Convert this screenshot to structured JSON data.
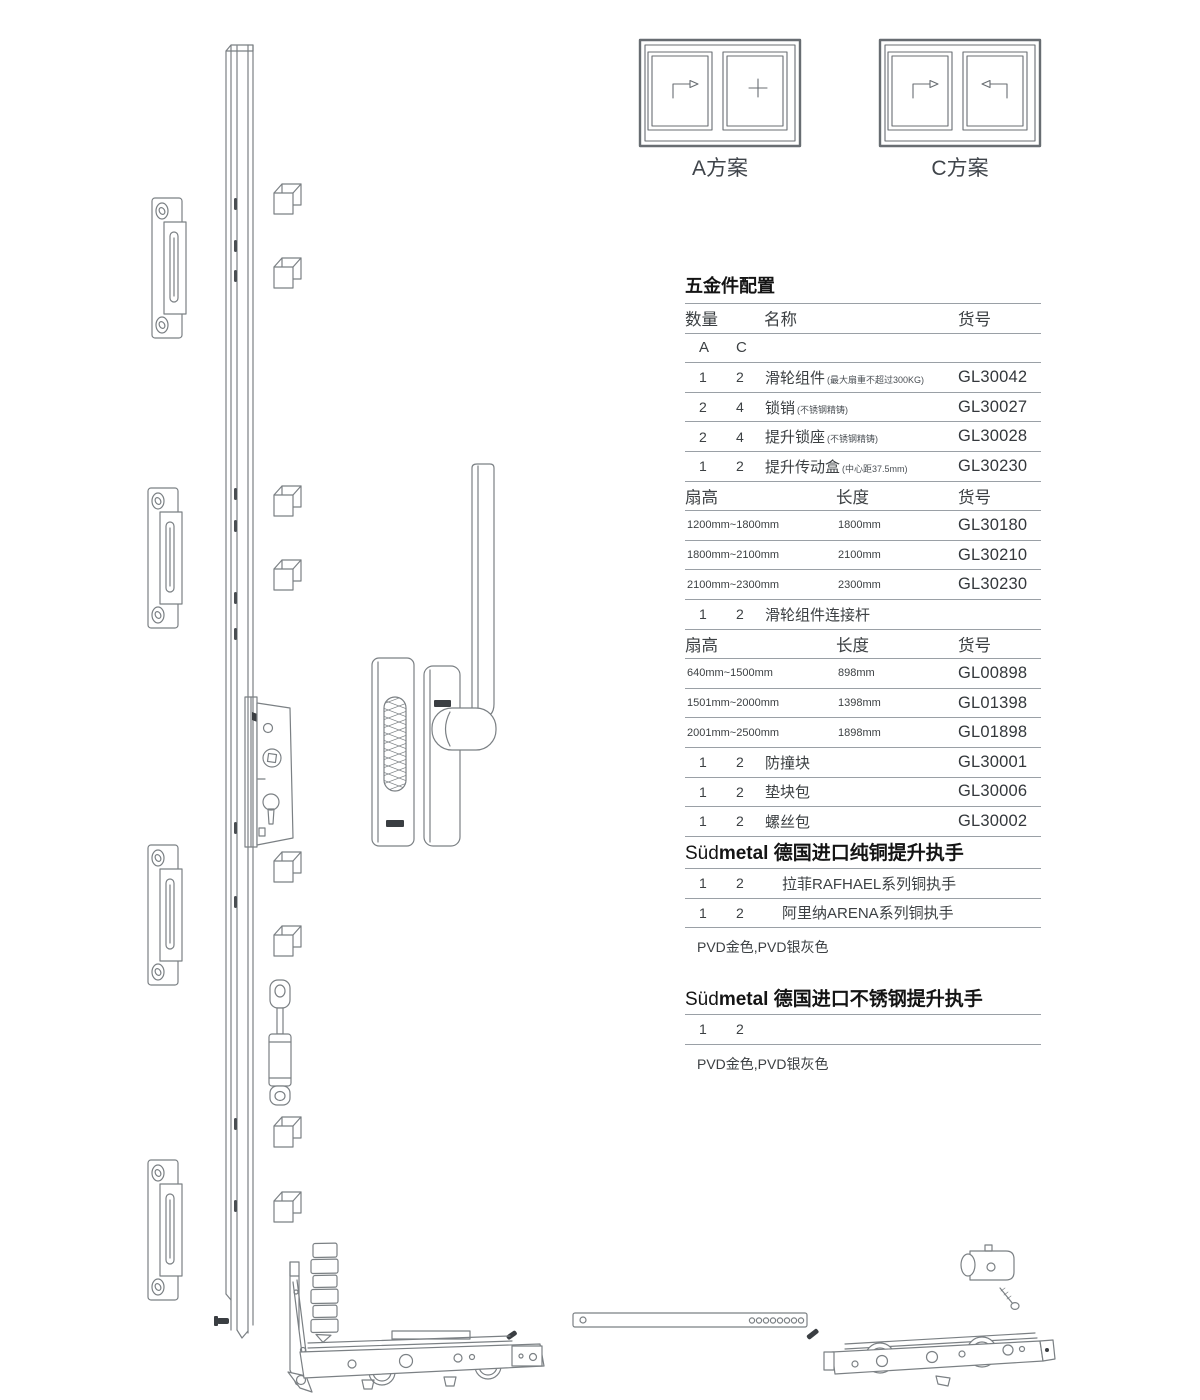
{
  "window_plans": {
    "a_label": "A方案",
    "c_label": "C方案"
  },
  "hardware_table": {
    "title": "五金件配置",
    "header": {
      "qty": "数量",
      "name": "名称",
      "sku": "货号"
    },
    "qty_columns": {
      "a": "A",
      "c": "C"
    },
    "parts": [
      {
        "a": "1",
        "c": "2",
        "name": "滑轮组件",
        "note": "(最大扇重不超过300KG)",
        "sku": "GL30042"
      },
      {
        "a": "2",
        "c": "4",
        "name": "锁销",
        "note": "(不锈钢精铸)",
        "sku": "GL30027"
      },
      {
        "a": "2",
        "c": "4",
        "name": "提升锁座",
        "note": "(不锈钢精铸)",
        "sku": "GL30028"
      },
      {
        "a": "1",
        "c": "2",
        "name": "提升传动盒",
        "note": "(中心距37.5mm)",
        "sku": "GL30230"
      }
    ],
    "length_table_1": {
      "header": {
        "col1": "扇高",
        "col2": "长度",
        "col3": "货号"
      },
      "rows": [
        {
          "range": "1200mm~1800mm",
          "length": "1800mm",
          "sku": "GL30180"
        },
        {
          "range": "1800mm~2100mm",
          "length": "2100mm",
          "sku": "GL30210"
        },
        {
          "range": "2100mm~2300mm",
          "length": "2300mm",
          "sku": "GL30230"
        }
      ]
    },
    "connector_row": {
      "a": "1",
      "c": "2",
      "name": "滑轮组件连接杆",
      "note": "",
      "sku": ""
    },
    "length_table_2": {
      "header": {
        "col1": "扇高",
        "col2": "长度",
        "col3": "货号"
      },
      "rows": [
        {
          "range": "640mm~1500mm",
          "length": "898mm",
          "sku": "GL00898"
        },
        {
          "range": "1501mm~2000mm",
          "length": "1398mm",
          "sku": "GL01398"
        },
        {
          "range": "2001mm~2500mm",
          "length": "1898mm",
          "sku": "GL01898"
        }
      ]
    },
    "tail_parts": [
      {
        "a": "1",
        "c": "2",
        "name": "防撞块",
        "note": "",
        "sku": "GL30001"
      },
      {
        "a": "1",
        "c": "2",
        "name": "垫块包",
        "note": "",
        "sku": "GL30006"
      },
      {
        "a": "1",
        "c": "2",
        "name": "螺丝包",
        "note": "",
        "sku": "GL30002"
      }
    ]
  },
  "brass_handle_section": {
    "brand_light": "Süd",
    "brand_bold": "metal",
    "title": " 德国进口纯铜提升执手",
    "rows": [
      {
        "a": "1",
        "c": "2",
        "name": "拉菲RAFHAEL系列铜执手"
      },
      {
        "a": "1",
        "c": "2",
        "name": "阿里纳ARENA系列铜执手"
      }
    ],
    "finish_note": "PVD金色,PVD银灰色"
  },
  "stainless_handle_section": {
    "brand_light": "Süd",
    "brand_bold": "metal",
    "title": " 德国进口不锈钢提升执手",
    "row": {
      "a": "1",
      "c": "2"
    },
    "finish_note": "PVD金色,PVD银灰色"
  },
  "colors": {
    "ink": "#3c4043",
    "rule": "#9aa0a6",
    "line_art": "#7b8084"
  }
}
